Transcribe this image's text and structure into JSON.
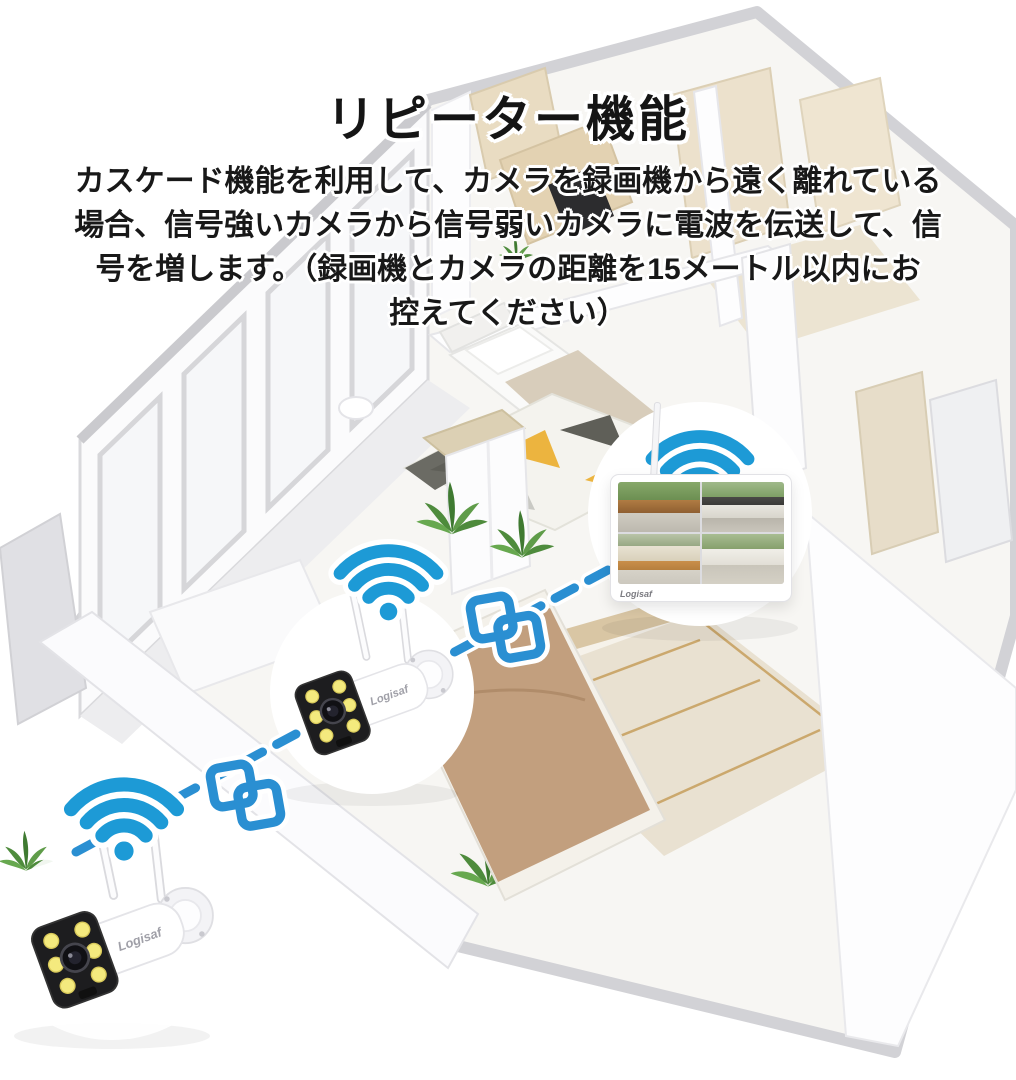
{
  "title": "リピーター機能",
  "description": [
    "カスケード機能を利用して、カメラを録画機から遠く離れている",
    "場合、信号強いカメラから信号弱いカメラに電波を伝送して、信",
    "号を増します。（録画機とカメラの距離を15メートル以内にお",
    "控えてください）",
    "15"
  ],
  "brand": "Logisaf",
  "monitor": {
    "brand": "Logisaf",
    "feed_count": "4"
  },
  "colors": {
    "wifi_blue": "#1d9ad6",
    "link_blue": "#2a8fd2",
    "dash_blue": "#2a8fd2",
    "led_yellow": "#f4ea7e",
    "rug_yellow": "#ecb43f",
    "rug_dark": "#5f5f58",
    "wood_beige": "#dcd0b4",
    "blanket_tan": "#c29f7e",
    "text_black": "#151515"
  },
  "icons": {
    "wifi": "wifi-signal-icon",
    "link": "repeater-link-icon",
    "dash": "wireless-connection-line"
  }
}
